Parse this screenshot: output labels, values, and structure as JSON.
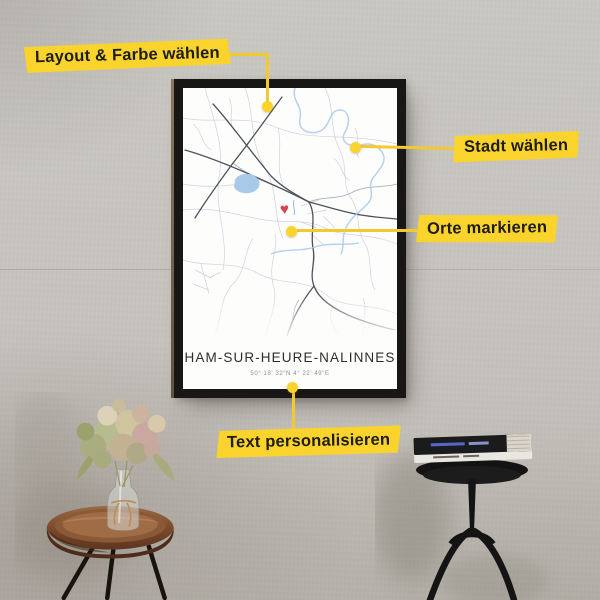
{
  "callouts": {
    "layout_color": {
      "label": "Layout & Farbe wählen"
    },
    "city": {
      "label": "Stadt wählen"
    },
    "places": {
      "label": "Orte markieren"
    },
    "personalize": {
      "label": "Text personalisieren"
    }
  },
  "poster": {
    "city_title": "HAM-SUR-HEURE-NALINNES",
    "coordinates": "50° 18' 32\"N  4° 22' 49\"E"
  },
  "icons": {
    "heart_marker": "♥"
  },
  "colors": {
    "accent_yellow": "#FBD32D",
    "heart_red": "#D4454F",
    "water_blue": "#A9C9E9",
    "road_dark": "#4D525C",
    "frame_black": "#181716",
    "wall_gray": "#C7C4BF"
  }
}
